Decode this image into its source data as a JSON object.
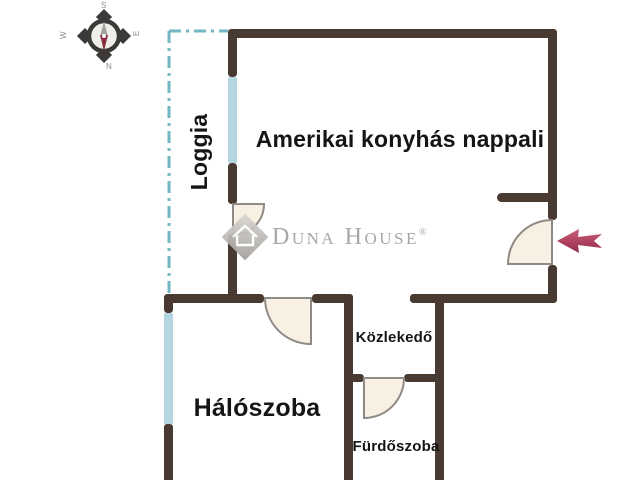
{
  "floor_plan": {
    "rooms": [
      {
        "name": "Amerikai konyhás nappali"
      },
      {
        "name": "Loggia"
      },
      {
        "name": "Hálószoba"
      },
      {
        "name": "Közlekedő"
      },
      {
        "name": "Fürdőszoba"
      }
    ],
    "compass": {
      "north": "N",
      "south": "S",
      "east": "E",
      "west": "W"
    },
    "colors": {
      "wall": "#483931",
      "window": "#b3d6e1",
      "loggia_boundary": "#72b5c3",
      "door_fill": "#f8f1e3",
      "door_stroke": "#8e8b86",
      "entrance_arrow": "#a93552",
      "label_text": "#151515",
      "watermark_text": "#a3a19d"
    }
  },
  "watermark": {
    "brand": "Duna House",
    "registered_mark": "®"
  },
  "icons": {
    "compass_rose": "compass-rose",
    "entrance_arrow": "left-arrow",
    "logo_mark": "diamond-house"
  }
}
